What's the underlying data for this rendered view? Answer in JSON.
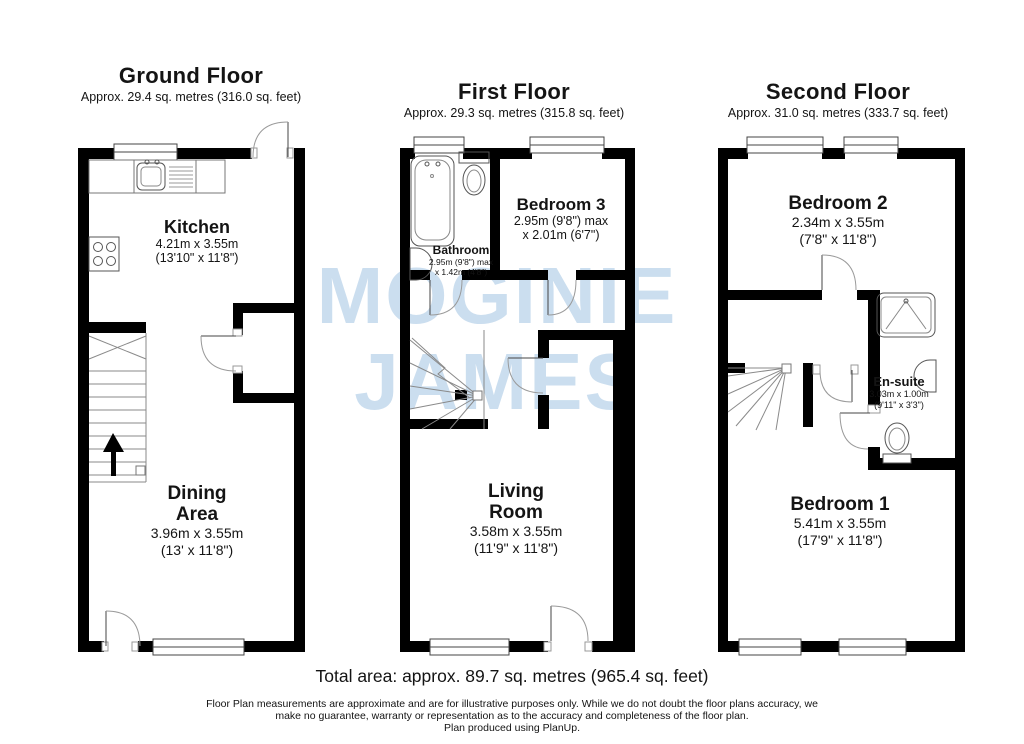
{
  "colors": {
    "wall": "#000000",
    "fixture_line": "#555555",
    "door_arc": "#9a9a9a",
    "watermark": "#cbdeef"
  },
  "watermark": {
    "line1": "MOGINIE",
    "line2": "JAMES"
  },
  "floors": [
    {
      "title": "Ground Floor",
      "area": "Approx. 29.4 sq. metres (316.0 sq. feet)",
      "rooms": [
        {
          "name_lines": [
            "Kitchen"
          ],
          "dims": [
            "4.21m x 3.55m",
            "(13'10\" x 11'8\")"
          ]
        },
        {
          "name_lines": [
            "Dining",
            "Area"
          ],
          "dims": [
            "3.96m x 3.55m",
            "(13' x 11'8\")"
          ]
        }
      ],
      "fixtures": [
        "window",
        "entry-door",
        "sink-and-drainer",
        "hob",
        "staircase-up-arrow",
        "cupboard-door",
        "internal-door"
      ]
    },
    {
      "title": "First Floor",
      "area": "Approx. 29.3 sq. metres (315.8 sq. feet)",
      "rooms": [
        {
          "name_lines": [
            "Bathroom"
          ],
          "dims": [
            "2.95m (9'8\") max",
            "x 1.42m (4'8\")"
          ]
        },
        {
          "name_lines": [
            "Bedroom 3"
          ],
          "dims": [
            "2.95m (9'8\") max",
            "x 2.01m (6'7\")"
          ]
        },
        {
          "name_lines": [
            "Living",
            "Room"
          ],
          "dims": [
            "3.58m x 3.55m",
            "(11'9\" x 11'8\")"
          ]
        }
      ],
      "fixtures": [
        "windows",
        "bath",
        "toilet",
        "wash-basin",
        "staircase",
        "internal-doors"
      ]
    },
    {
      "title": "Second Floor",
      "area": "Approx. 31.0 sq. metres (333.7 sq. feet)",
      "rooms": [
        {
          "name_lines": [
            "Bedroom 2"
          ],
          "dims": [
            "2.34m x 3.55m",
            "(7'8\" x 11'8\")"
          ]
        },
        {
          "name_lines": [
            "En-suite"
          ],
          "dims": [
            "3.03m x 1.00m",
            "(9'11\" x 3'3\")"
          ]
        },
        {
          "name_lines": [
            "Bedroom 1"
          ],
          "dims": [
            "5.41m x 3.55m",
            "(17'9\" x 11'8\")"
          ]
        }
      ],
      "fixtures": [
        "windows",
        "shower",
        "wash-basin",
        "toilet",
        "staircase",
        "internal-doors"
      ]
    }
  ],
  "footer": {
    "total": "Total area: approx. 89.7 sq. metres (965.4 sq. feet)",
    "disclaimer_lines": [
      "Floor Plan measurements are approximate and are for illustrative purposes only. While we do not doubt the floor plans accuracy, we",
      "make no guarantee, warranty or representation as to the accuracy and completeness of the floor plan.",
      "Plan produced using PlanUp."
    ]
  }
}
